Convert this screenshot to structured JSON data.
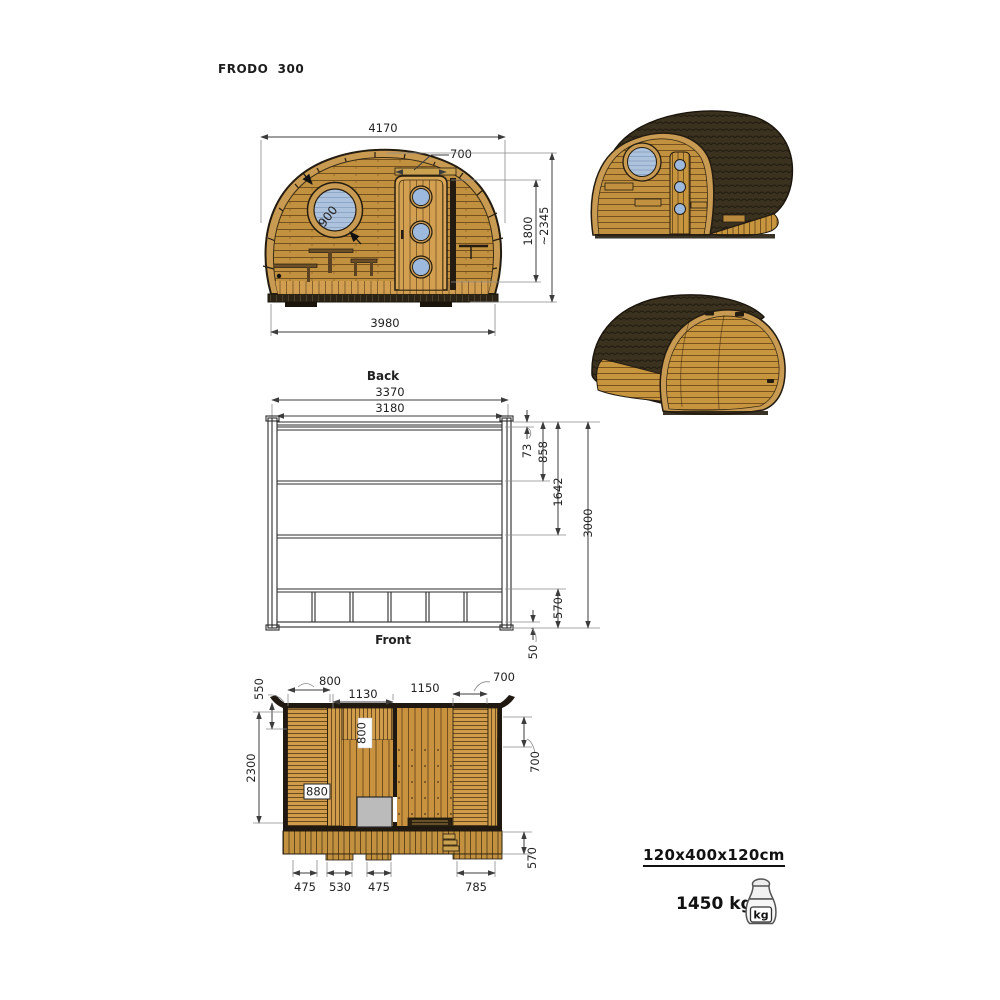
{
  "title": "FRODO  300",
  "elevation": {
    "dim_width_top": "4170",
    "dim_door_width": "700",
    "dim_window": "900",
    "dim_door_height": "1800",
    "dim_total_height": "~2345",
    "dim_width_bottom": "3980"
  },
  "base_view": {
    "label_back": "Back",
    "label_front": "Front",
    "dim_outer_width": "3370",
    "dim_inner_width": "3180",
    "dim_top_offset": "73",
    "dim_beam1": "858",
    "dim_beam2": "1642",
    "dim_length": "3000",
    "dim_front_section": "570",
    "dim_overhang": "50"
  },
  "floor_plan": {
    "dim_side_550": "550",
    "dim_top_800": "800",
    "dim_top_1130": "1130",
    "dim_top_1150": "1150",
    "dim_top_700": "700",
    "dim_right_700": "700",
    "dim_left_2300": "2300",
    "dim_inner_800": "800",
    "dim_inner_880": "880",
    "dim_right_570": "570",
    "dim_bottom_475a": "475",
    "dim_bottom_530": "530",
    "dim_bottom_475b": "475",
    "dim_bottom_785": "785"
  },
  "specs": {
    "footprint": "120x400x120cm",
    "weight": "1450 kg",
    "weight_unit": "kg"
  },
  "colors": {
    "wood": "#c2913f",
    "wood_light": "#cf9c4a",
    "rim": "#c99b52",
    "roof": "#3a311f",
    "outline": "#241c10",
    "window_glass": "#adc2dc",
    "stove": "#bbbbbb",
    "dim_line": "#3c3c3c"
  }
}
